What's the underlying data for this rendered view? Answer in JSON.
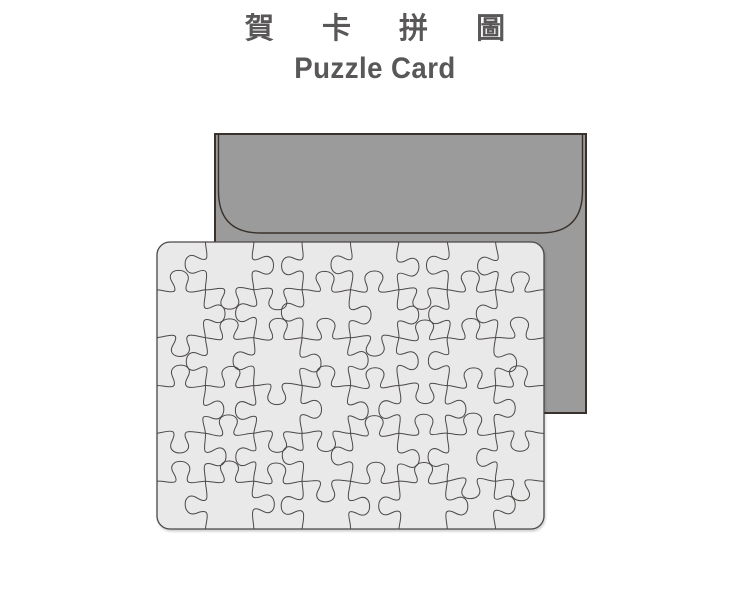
{
  "page": {
    "background": "#ffffff"
  },
  "title": {
    "zh": "賀 卡 拼 圖",
    "en": "Puzzle Card",
    "color": "#595757"
  },
  "envelope": {
    "name": "envelope",
    "fill": "#9b9b9b",
    "outline": "#39312b"
  },
  "puzzle_card": {
    "name": "puzzle-card",
    "fill": "#e9e9e9",
    "outline": "#4c4846",
    "cut_line_color": "#4c4846",
    "rows": 6,
    "cols": 8,
    "pieces": 48
  }
}
